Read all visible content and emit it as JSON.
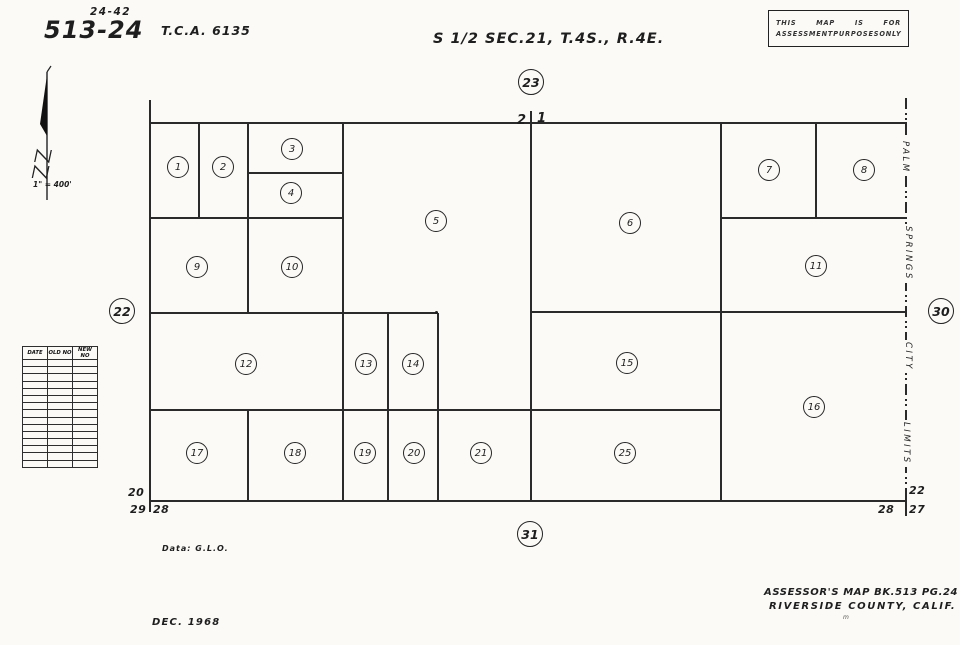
{
  "header": {
    "page_ref_small": "24-42",
    "book_page": "513-24",
    "tca": "T.C.A. 6135",
    "title": "S 1/2  SEC.21,  T.4S., R.4E.",
    "stamp": {
      "line1": [
        "THIS",
        "MAP",
        "IS",
        "FOR"
      ],
      "line2": [
        "ASSESSMENT",
        "PURPOSES",
        "ONLY"
      ]
    }
  },
  "north_arrow": {
    "scale_label": "1\" = 400'"
  },
  "revision_table": {
    "headers": [
      "DATE",
      "OLD NO",
      "NEW NO"
    ],
    "row_count": 15
  },
  "map": {
    "adjacent_page_refs": {
      "top": "23",
      "left": "22",
      "right": "30",
      "bottom": "31"
    },
    "top_section_tick": {
      "left_digit": "2",
      "right_digit": "1"
    },
    "corner_sections": {
      "bottom_left_above": "20",
      "bottom_left_below_left": "29",
      "bottom_left_below_right": "28",
      "bottom_right_above": "22",
      "bottom_right_below_left": "28",
      "bottom_right_below_right": "27"
    },
    "city_limits_words": [
      "PALM",
      "SPRINGS",
      "CITY",
      "LIMITS"
    ],
    "parcels": [
      "1",
      "2",
      "3",
      "4",
      "5",
      "6",
      "7",
      "8",
      "9",
      "10",
      "11",
      "12",
      "13",
      "14",
      "15",
      "16",
      "17",
      "18",
      "19",
      "20",
      "21",
      "25"
    ]
  },
  "footer": {
    "datum": "Data: G.L.O.",
    "assessor_line1": "ASSESSOR'S MAP BK.513 PG.24",
    "assessor_line2": "RIVERSIDE COUNTY, CALIF.",
    "mark": "m",
    "date": "DEC. 1968"
  }
}
